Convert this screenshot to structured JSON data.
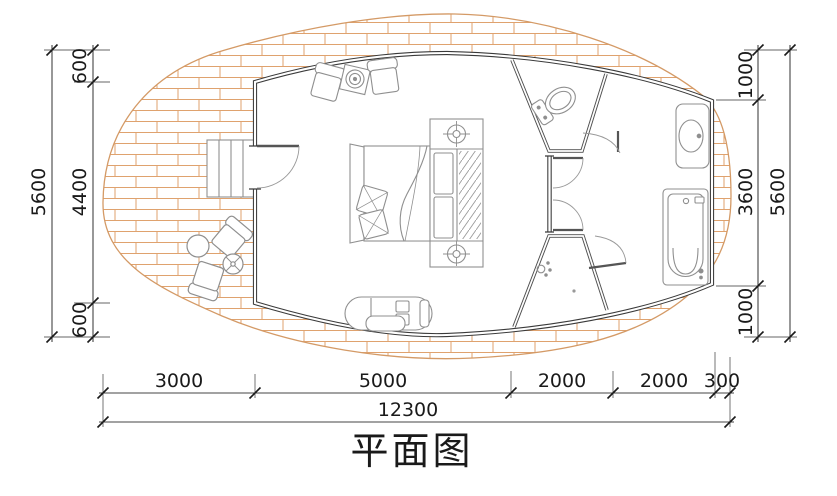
{
  "title": "平面图",
  "colors": {
    "brick_line": "#DFA26E",
    "deck_outline": "#D49A66",
    "exterior_wall": "#3A3A3A",
    "partition_wall": "#4F4F4F",
    "furniture_line": "#8F8F8F",
    "dimension_line": "#444444",
    "dimension_text": "#1A1A1A"
  },
  "dimensions": {
    "left": {
      "segments": [
        "600",
        "4400",
        "600"
      ],
      "total": "5600"
    },
    "right": {
      "segments": [
        "1000",
        "3600",
        "1000"
      ],
      "total": "5600"
    },
    "bottom": {
      "segments": [
        "3000",
        "5000",
        "2000",
        "2000",
        "300"
      ],
      "total": "12300"
    }
  }
}
